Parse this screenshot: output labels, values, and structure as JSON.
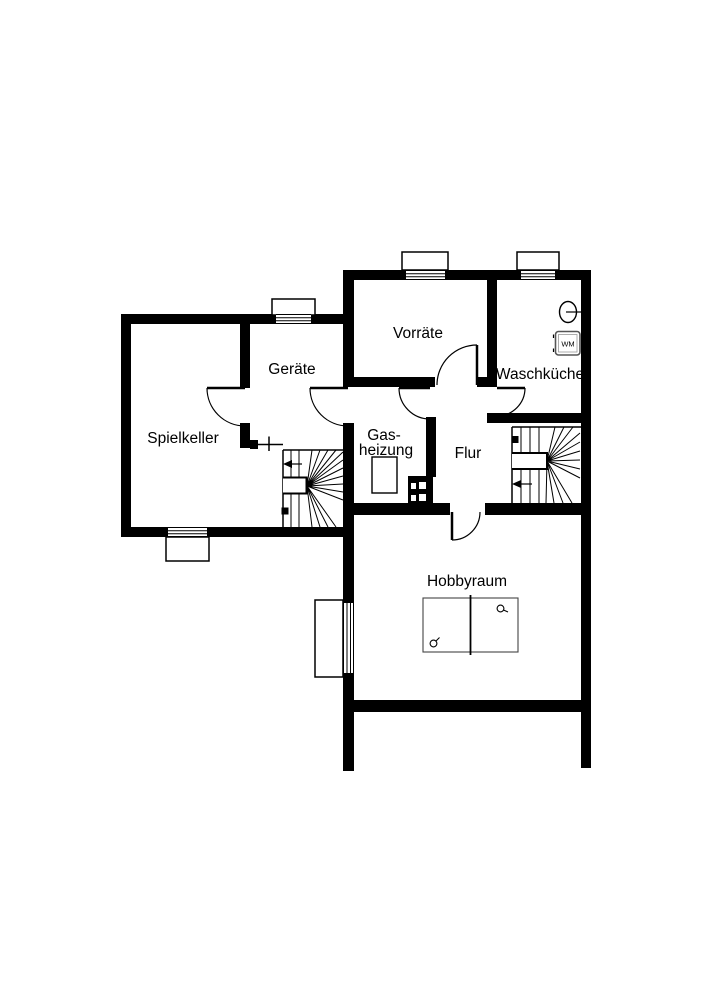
{
  "plan": {
    "type": "floor-plan",
    "colors": {
      "wall": "#000000",
      "background": "#ffffff",
      "line": "#000000",
      "watermark_text": "#ffffff"
    },
    "rooms": [
      {
        "id": "spielkeller",
        "label": "Spielkeller"
      },
      {
        "id": "geraete",
        "label": "Geräte"
      },
      {
        "id": "vorraete",
        "label": "Vorräte"
      },
      {
        "id": "waschkueche",
        "label": "Waschküche"
      },
      {
        "id": "gasheizung",
        "label_lines": [
          "Gas-",
          "heizung"
        ]
      },
      {
        "id": "flur",
        "label": "Flur"
      },
      {
        "id": "hobbyraum",
        "label": "Hobbyraum"
      }
    ],
    "appliances": {
      "washing_machine_label": "WM"
    },
    "watermark": {
      "text": "McGrundriss"
    }
  }
}
